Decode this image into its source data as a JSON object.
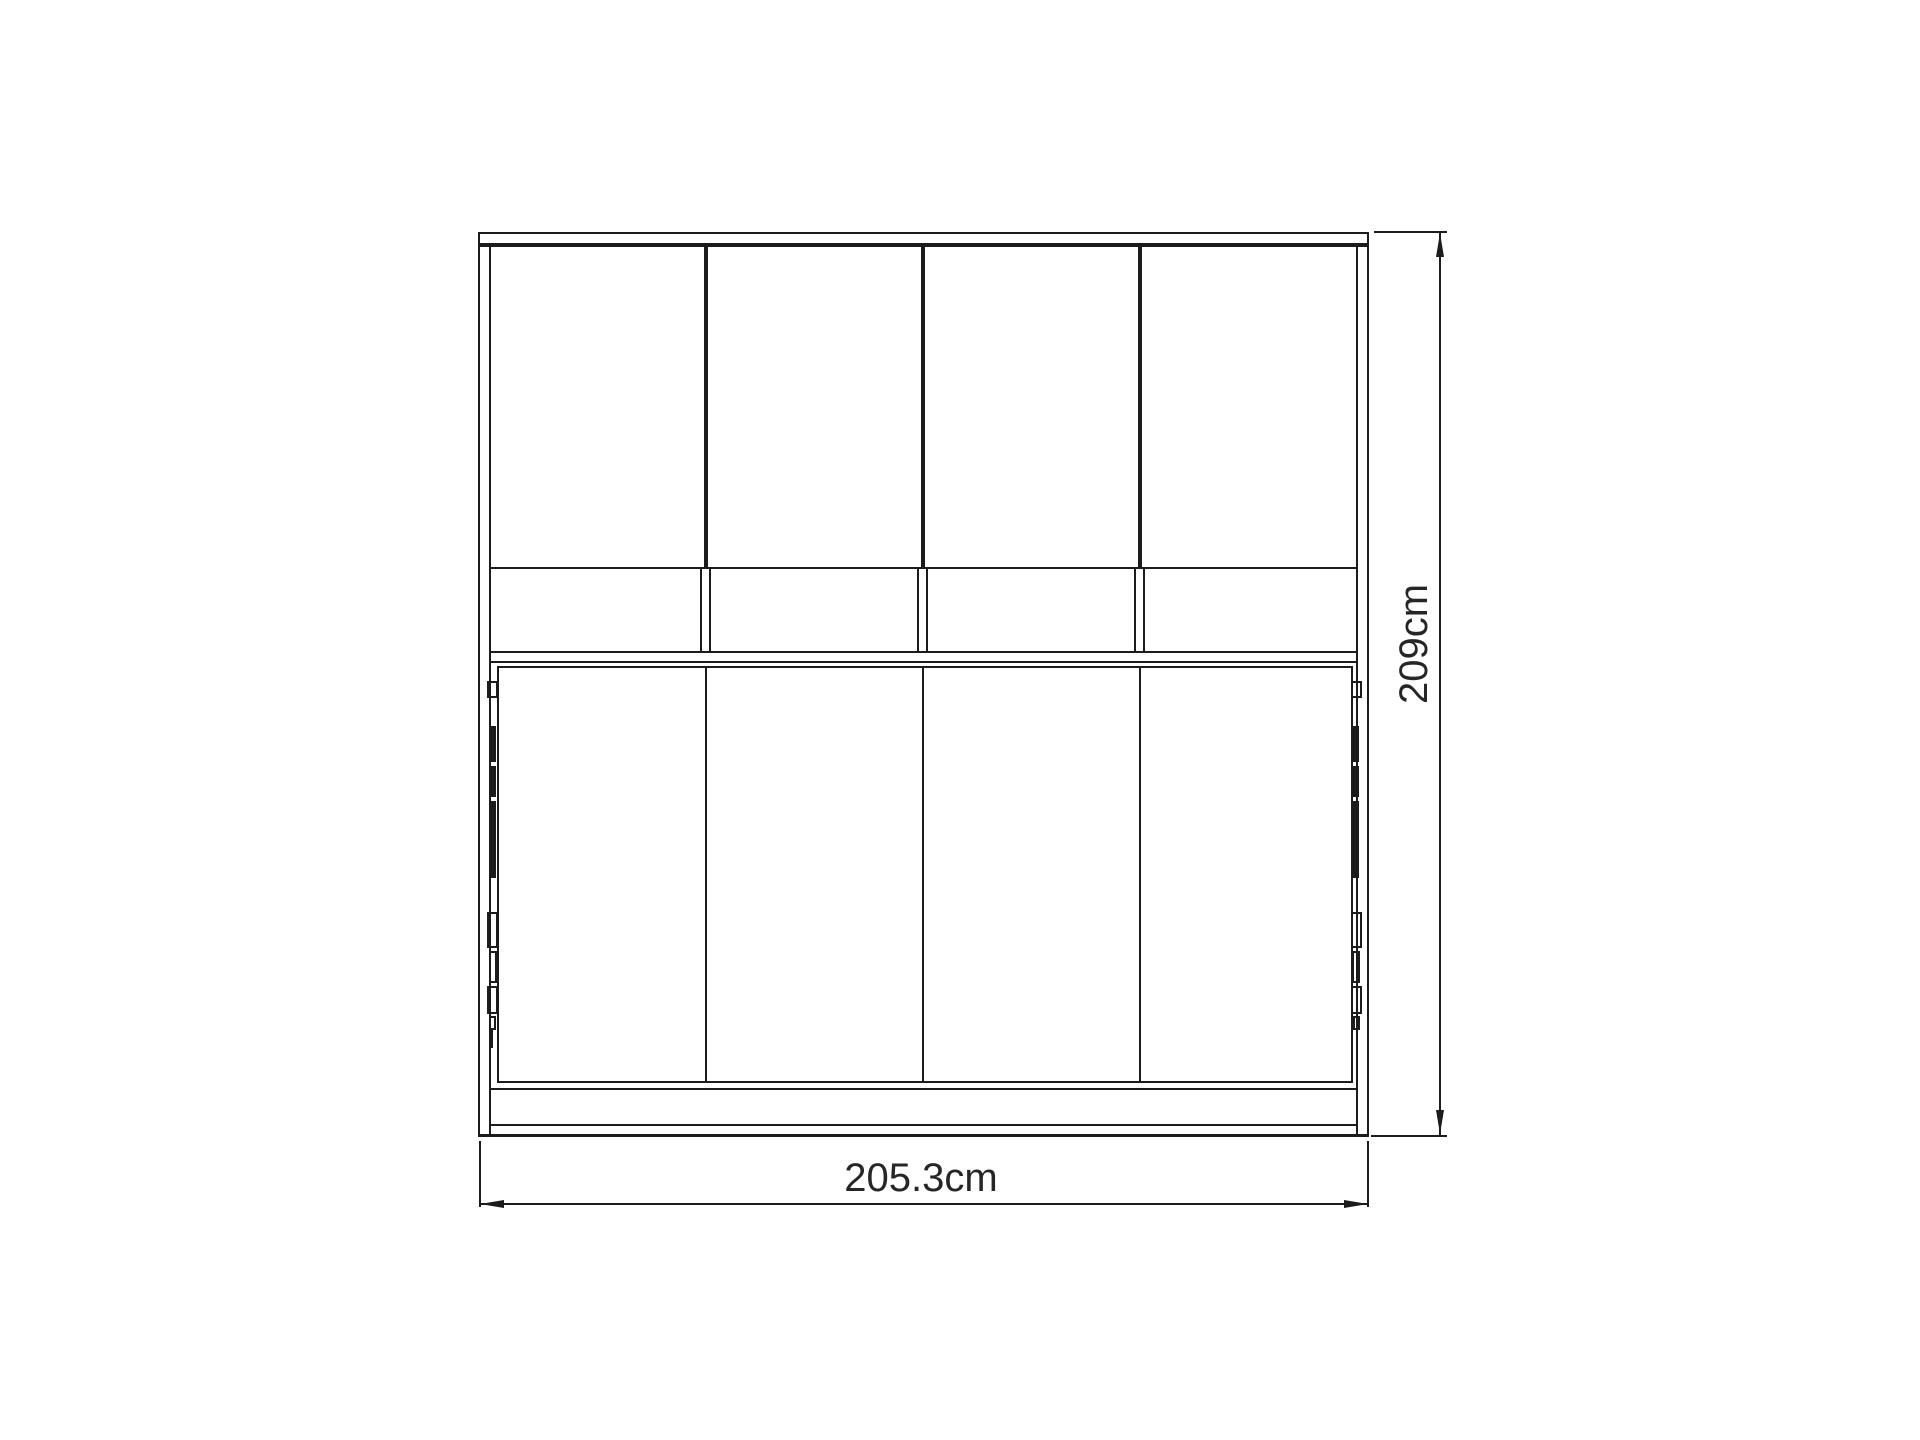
{
  "drawing": {
    "view": "front elevation",
    "background": "#ffffff",
    "line_color": "#1c1c1c",
    "dimensions": {
      "width": {
        "label": "205.3cm"
      },
      "height": {
        "label": "209cm"
      }
    },
    "components": {
      "top_doors": 4,
      "flap_compartments": 4,
      "bed_front_sections": 4
    }
  }
}
